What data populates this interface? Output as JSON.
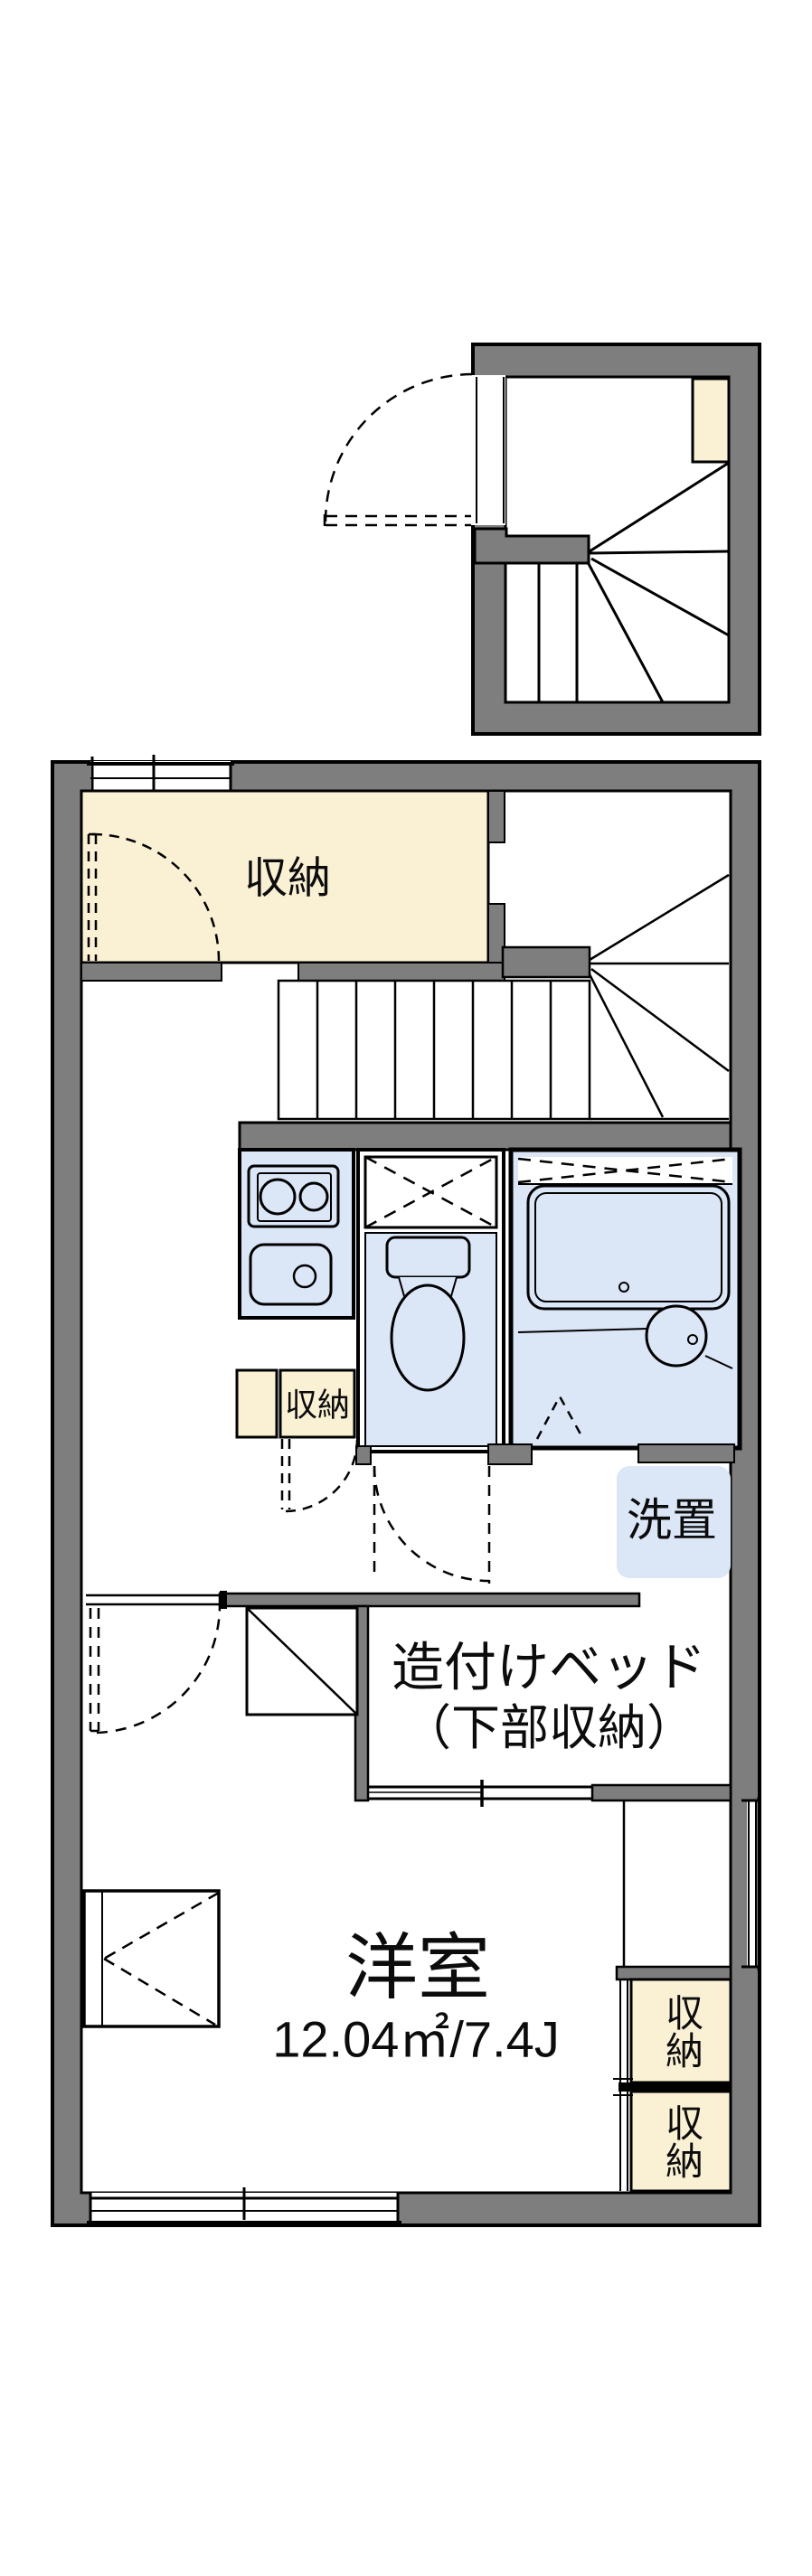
{
  "floorplan": {
    "labels": {
      "upper_storage": "収納",
      "hall_storage": "収納",
      "laundry": "洗置",
      "built_in_bed_line1": "造付けベッド",
      "built_in_bed_line2": "（下部収納）",
      "room_name": "洋室",
      "room_size": "12.04㎡/7.4J",
      "closet_upper": "収納",
      "closet_lower": "収納"
    },
    "colors": {
      "wall_gray": "#7e7e7e",
      "storage_cream": "#faf1d5",
      "wet_area_blue": "#dbe6f7",
      "line_black": "#000000",
      "background": "#ffffff"
    }
  }
}
